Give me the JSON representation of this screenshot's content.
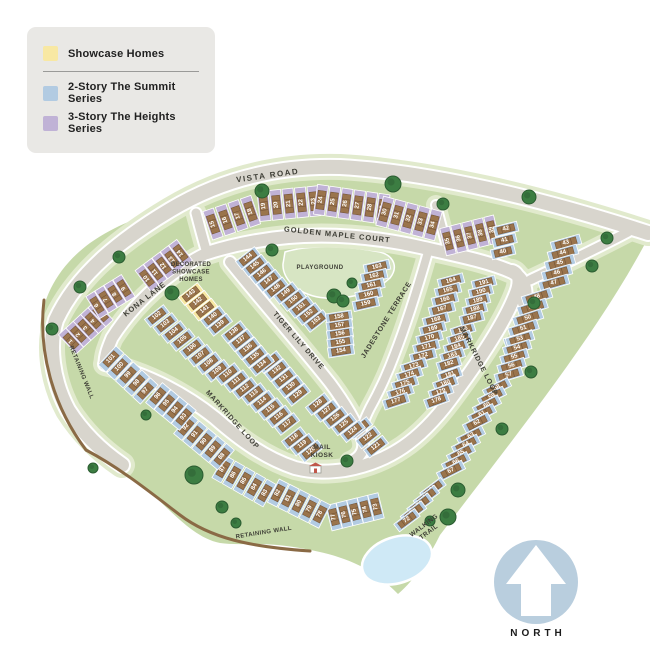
{
  "legend": {
    "items": [
      {
        "label": "Showcase Homes",
        "series": "showcase"
      },
      {
        "label": "2-Story The Summit Series",
        "series": "summit"
      },
      {
        "label": "3-Story The Heights Series",
        "series": "heights"
      }
    ]
  },
  "north": {
    "label": "NORTH"
  },
  "colors": {
    "land": "#c6d9a9",
    "verge": "#e1eacd",
    "road": "#d8d5cd",
    "road_edge": "#ffffff",
    "wall": "#8a6a45",
    "house": "#9a744c",
    "house_line": "#6e4f33",
    "tree": "#3c7d42",
    "tree_edge": "#2b5c31",
    "pond": "#cfe9f6",
    "playground": "#d7e5c3",
    "north_circle": "#b9cede",
    "series": {
      "summit": "#b2cbe2",
      "heights": "#c0b2d6",
      "showcase": "#f8e8a3"
    }
  },
  "map": {
    "labels": [
      {
        "id": "vista-road",
        "text": "VISTA ROAD",
        "x": 268,
        "y": 178,
        "rot": -8,
        "size": 8,
        "ls": 1.5
      },
      {
        "id": "golden-maple-court",
        "text": "GOLDEN MAPLE COURT",
        "x": 337,
        "y": 237,
        "rot": 6,
        "size": 7.5,
        "ls": 1
      },
      {
        "id": "kona-lane",
        "text": "KONA LANE",
        "x": 146,
        "y": 301,
        "rot": -38,
        "size": 7.5,
        "ls": 0.8
      },
      {
        "id": "tiger-lily-drive",
        "text": "TIGER LILY DRIVE",
        "x": 297,
        "y": 342,
        "rot": 49,
        "size": 7,
        "ls": 0.8
      },
      {
        "id": "jadestone-terrace",
        "text": "JADESTONE TERRACE",
        "x": 388,
        "y": 321,
        "rot": -58,
        "size": 7,
        "ls": 0.6
      },
      {
        "id": "markridge-loop-west",
        "text": "MARKRIDGE LOOP",
        "x": 231,
        "y": 421,
        "rot": 48,
        "size": 7,
        "ls": 0.8
      },
      {
        "id": "markridge-loop-east",
        "text": "MARKRIDGE LOOP",
        "x": 477,
        "y": 362,
        "rot": 63,
        "size": 7,
        "ls": 0.8
      },
      {
        "id": "retaining-wall-left",
        "text": "RETAINING WALL",
        "x": 80,
        "y": 373,
        "rot": 68,
        "size": 6,
        "ls": 0.4
      },
      {
        "id": "retaining-wall-bottom",
        "text": "RETAINING WALL",
        "x": 264,
        "y": 534,
        "rot": -9,
        "size": 6,
        "ls": 0.4
      },
      {
        "id": "playground",
        "lines": [
          "PLAYGROUND"
        ],
        "x": 320,
        "y": 269,
        "rot": 0,
        "size": 6,
        "ls": 0.5
      },
      {
        "id": "mail-kiosk",
        "lines": [
          "MAIL",
          "KIOSK"
        ],
        "x": 322,
        "y": 449,
        "rot": 0,
        "size": 6.5,
        "ls": 0.4
      },
      {
        "id": "walking-trail",
        "lines": [
          "WALKING",
          "TRAIL"
        ],
        "x": 425,
        "y": 527,
        "rot": -37,
        "size": 6.5,
        "ls": 0.4
      },
      {
        "id": "decorated-showcase-homes",
        "lines": [
          "DECORATED",
          "SHOWCASE",
          "HOMES"
        ],
        "x": 191,
        "y": 266,
        "rot": 0,
        "size": 6,
        "ls": 0.3
      }
    ],
    "lot_groups": [
      {
        "series": "heights",
        "nums": [
          15,
          16,
          17,
          18
        ],
        "start": [
          213,
          224
        ],
        "step": [
          12.5,
          -4.2
        ],
        "angle": -19,
        "lot": [
          11,
          30
        ],
        "text_rot": -90
      },
      {
        "series": "heights",
        "nums": [
          19,
          20,
          21,
          22,
          23
        ],
        "start": [
          264,
          206
        ],
        "step": [
          12.5,
          -1.2
        ],
        "angle": -6,
        "lot": [
          11,
          30
        ],
        "text_rot": -90
      },
      {
        "series": "heights",
        "nums": [
          24,
          25,
          26,
          27,
          28,
          29
        ],
        "start": [
          321,
          200
        ],
        "step": [
          12.3,
          1.8
        ],
        "angle": 8,
        "lot": [
          11,
          30
        ],
        "text_rot": -90
      },
      {
        "series": "heights",
        "nums": [
          30,
          31,
          32,
          33,
          34
        ],
        "start": [
          385,
          212
        ],
        "step": [
          12,
          3.2
        ],
        "angle": 15,
        "lot": [
          11,
          30
        ],
        "text_rot": -90
      },
      {
        "series": "heights",
        "nums": [
          35,
          36,
          37,
          38,
          39
        ],
        "start": [
          448,
          241
        ],
        "step": [
          11,
          -2.8
        ],
        "angle": -14,
        "lot": [
          10,
          28
        ],
        "text_rot": -90
      },
      {
        "series": "heights",
        "nums": [
          1,
          2,
          3,
          4,
          5
        ],
        "start": [
          71,
          341
        ],
        "step": [
          7.4,
          -6.8
        ],
        "angle": -43,
        "lot": [
          10,
          26
        ],
        "text_rot": -90
      },
      {
        "series": "heights",
        "nums": [
          6,
          7,
          8,
          9
        ],
        "start": [
          97,
          305
        ],
        "step": [
          9,
          -5.6
        ],
        "angle": -32,
        "lot": [
          10,
          26
        ],
        "text_rot": -90
      },
      {
        "series": "heights",
        "nums": [
          10,
          11,
          12,
          13,
          14
        ],
        "start": [
          147,
          278
        ],
        "step": [
          8.4,
          -6.3
        ],
        "angle": -37,
        "lot": [
          10,
          26
        ],
        "text_rot": -90
      },
      {
        "series": "summit",
        "nums": [
          42,
          41,
          40
        ],
        "start": [
          506,
          229
        ],
        "step": [
          -1.5,
          11.5
        ],
        "angle": -14,
        "lot": [
          24,
          10
        ],
        "text_rot": 0
      },
      {
        "series": "summit",
        "nums": [
          43,
          44,
          45,
          46,
          47
        ],
        "start": [
          566,
          243
        ],
        "step": [
          -3,
          10
        ],
        "angle": -16,
        "lot": [
          30,
          10
        ],
        "text_rot": 0
      },
      {
        "series": "summit",
        "nums": [
          48,
          49,
          50,
          51,
          52
        ],
        "start": [
          537,
          297
        ],
        "step": [
          -4.5,
          10.5
        ],
        "angle": -18,
        "lot": [
          30,
          10
        ],
        "text_rot": 0
      },
      {
        "series": "summit",
        "nums": [
          53,
          54,
          55,
          56,
          57
        ],
        "start": [
          520,
          339
        ],
        "step": [
          -2.8,
          9
        ],
        "angle": -17,
        "lot": [
          28,
          9.5
        ],
        "text_rot": 0
      },
      {
        "series": "summit",
        "nums": [
          58,
          59,
          60,
          61,
          62
        ],
        "start": [
          497,
          388
        ],
        "step": [
          -5,
          8.7
        ],
        "angle": -27,
        "lot": [
          28,
          9.5
        ],
        "text_rot": 0
      },
      {
        "series": "summit",
        "nums": [
          63,
          64,
          65,
          66,
          67
        ],
        "start": [
          471,
          436
        ],
        "step": [
          -5,
          8.7
        ],
        "angle": -27,
        "lot": [
          28,
          9.5
        ],
        "text_rot": 0
      },
      {
        "series": "summit",
        "nums": [
          68,
          69,
          70,
          71,
          72
        ],
        "start": [
          433,
          489
        ],
        "step": [
          -6.5,
          7.8
        ],
        "angle": -37,
        "lot": [
          26,
          9.5
        ],
        "text_rot": 0
      },
      {
        "series": "summit",
        "nums": [
          77,
          76,
          75,
          74,
          73
        ],
        "start": [
          334,
          517
        ],
        "step": [
          10.5,
          -2.6
        ],
        "angle": -14,
        "lot": [
          10.5,
          26
        ],
        "text_rot": -90
      },
      {
        "series": "summit",
        "nums": [
          82,
          81,
          80,
          79,
          78
        ],
        "start": [
          278,
          493
        ],
        "step": [
          10.5,
          5.3
        ],
        "angle": 27,
        "lot": [
          10.5,
          26
        ],
        "text_rot": -90
      },
      {
        "series": "summit",
        "nums": [
          87,
          86,
          85,
          84,
          83
        ],
        "start": [
          223,
          469
        ],
        "step": [
          10.5,
          6
        ],
        "angle": 30,
        "lot": [
          10.5,
          26
        ],
        "text_rot": -90
      },
      {
        "series": "summit",
        "nums": [
          92,
          91,
          90,
          89,
          88
        ],
        "start": [
          186,
          427
        ],
        "step": [
          9,
          7.4
        ],
        "angle": 40,
        "lot": [
          10.5,
          26
        ],
        "text_rot": -90
      },
      {
        "series": "summit",
        "nums": [
          96,
          95,
          94,
          93
        ],
        "start": [
          158,
          396
        ],
        "step": [
          8.6,
          7
        ],
        "angle": 40,
        "lot": [
          10.5,
          26
        ],
        "text_rot": -90
      },
      {
        "series": "summit",
        "nums": [
          101,
          100,
          99,
          98,
          97
        ],
        "start": [
          111,
          359
        ],
        "step": [
          8.6,
          8
        ],
        "angle": 43,
        "lot": [
          10.5,
          26
        ],
        "text_rot": -90
      },
      {
        "series": "summit",
        "nums": [
          102,
          103,
          104,
          105
        ],
        "start": [
          157,
          316
        ],
        "step": [
          8.5,
          8
        ],
        "angle": -38,
        "lot": [
          24,
          10
        ],
        "text_rot": 0
      },
      {
        "series": "summit",
        "nums": [
          106,
          107,
          108,
          109
        ],
        "start": [
          192,
          348
        ],
        "step": [
          8.5,
          7.6
        ],
        "angle": -38,
        "lot": [
          24,
          10
        ],
        "text_rot": 0
      },
      {
        "series": "summit",
        "nums": [
          110,
          111,
          112
        ],
        "start": [
          228,
          374
        ],
        "step": [
          8.5,
          7.2
        ],
        "angle": -38,
        "lot": [
          24,
          10
        ],
        "text_rot": 0
      },
      {
        "series": "summit",
        "nums": [
          113,
          114,
          115,
          116,
          117
        ],
        "start": [
          254,
          394
        ],
        "step": [
          8.3,
          7.5
        ],
        "angle": -38,
        "lot": [
          24,
          10
        ],
        "text_rot": 0
      },
      {
        "series": "summit",
        "nums": [
          118,
          119,
          120
        ],
        "start": [
          294,
          438
        ],
        "step": [
          8.5,
          6.6
        ],
        "angle": -38,
        "lot": [
          24,
          10
        ],
        "text_rot": 0
      },
      {
        "series": "summit",
        "nums": [
          123,
          122,
          121
        ],
        "start": [
          360,
          428
        ],
        "step": [
          8,
          9.3
        ],
        "angle": -38,
        "lot": [
          24,
          10
        ],
        "text_rot": 0
      },
      {
        "series": "summit",
        "nums": [
          128,
          127,
          126,
          125,
          124
        ],
        "start": [
          318,
          404
        ],
        "step": [
          8.7,
          6.8
        ],
        "angle": -38,
        "lot": [
          24,
          10
        ],
        "text_rot": 0
      },
      {
        "series": "summit",
        "nums": [
          133,
          132,
          131,
          130,
          129
        ],
        "start": [
          270,
          362
        ],
        "step": [
          7,
          8.2
        ],
        "angle": -38,
        "lot": [
          24,
          10
        ],
        "text_rot": 0
      },
      {
        "series": "summit",
        "nums": [
          138,
          137,
          136,
          135,
          134
        ],
        "start": [
          234,
          332
        ],
        "step": [
          7,
          8.2
        ],
        "angle": -38,
        "lot": [
          24,
          10
        ],
        "text_rot": 0
      },
      {
        "series": "showcase",
        "nums": [
          143,
          142,
          141
        ],
        "start": [
          191,
          294
        ],
        "step": [
          7,
          7.8
        ],
        "angle": -38,
        "lot": [
          24,
          10
        ],
        "text_rot": 0
      },
      {
        "series": "summit",
        "nums": [
          140,
          139
        ],
        "start": [
          213,
          317
        ],
        "step": [
          7,
          7.8
        ],
        "angle": -38,
        "lot": [
          24,
          10
        ],
        "text_rot": 0
      },
      {
        "series": "summit",
        "nums": [
          144,
          145,
          146,
          147,
          148
        ],
        "start": [
          248,
          258
        ],
        "step": [
          7,
          7.6
        ],
        "angle": -38,
        "lot": [
          24,
          10
        ],
        "text_rot": 0
      },
      {
        "series": "summit",
        "nums": [
          149,
          150,
          151,
          152,
          153
        ],
        "start": [
          286,
          293
        ],
        "step": [
          7.6,
          7
        ],
        "angle": -38,
        "lot": [
          24,
          10
        ],
        "text_rot": 0
      },
      {
        "series": "summit",
        "nums": [
          163,
          162,
          161,
          160,
          159
        ],
        "start": [
          377,
          267
        ],
        "step": [
          -2.8,
          9.2
        ],
        "angle": -13,
        "lot": [
          26,
          10
        ],
        "text_rot": 0
      },
      {
        "series": "summit",
        "nums": [
          158,
          157,
          156,
          155,
          154
        ],
        "start": [
          339,
          317
        ],
        "step": [
          0.5,
          8.5
        ],
        "angle": -9,
        "lot": [
          26,
          10
        ],
        "text_rot": 0
      },
      {
        "series": "summit",
        "nums": [
          164,
          165,
          166,
          167
        ],
        "start": [
          451,
          281
        ],
        "step": [
          -3,
          9.4
        ],
        "angle": -15,
        "lot": [
          26,
          10
        ],
        "text_rot": 0
      },
      {
        "series": "summit",
        "nums": [
          168,
          169,
          170,
          171,
          172
        ],
        "start": [
          436,
          320
        ],
        "step": [
          -3.2,
          9
        ],
        "angle": -15,
        "lot": [
          26,
          10
        ],
        "text_rot": 0
      },
      {
        "series": "summit",
        "nums": [
          173,
          174,
          175,
          176,
          177
        ],
        "start": [
          414,
          366
        ],
        "step": [
          -4.5,
          8.8
        ],
        "angle": -18,
        "lot": [
          26,
          10
        ],
        "text_rot": 0
      },
      {
        "series": "summit",
        "nums": [
          181,
          180,
          179,
          178
        ],
        "start": [
          450,
          375
        ],
        "step": [
          -4.5,
          8.5
        ],
        "angle": -20,
        "lot": [
          24,
          10
        ],
        "text_rot": 0
      },
      {
        "series": "summit",
        "nums": [
          186,
          185,
          184,
          183,
          182
        ],
        "start": [
          463,
          330
        ],
        "step": [
          -3.5,
          8.5
        ],
        "angle": -18,
        "lot": [
          24,
          10
        ],
        "text_rot": 0
      },
      {
        "series": "summit",
        "nums": [
          191,
          190,
          189,
          188,
          187
        ],
        "start": [
          484,
          283
        ],
        "step": [
          -3,
          8.8
        ],
        "angle": -15,
        "lot": [
          24,
          10
        ],
        "text_rot": 0
      }
    ],
    "trees": [
      [
        262,
        191,
        7
      ],
      [
        393,
        184,
        8
      ],
      [
        529,
        197,
        7
      ],
      [
        443,
        204,
        6
      ],
      [
        607,
        238,
        6
      ],
      [
        592,
        266,
        6
      ],
      [
        534,
        303,
        6
      ],
      [
        531,
        372,
        6
      ],
      [
        502,
        429,
        6
      ],
      [
        458,
        490,
        7
      ],
      [
        448,
        517,
        8
      ],
      [
        430,
        521,
        5
      ],
      [
        352,
        283,
        5
      ],
      [
        334,
        296,
        7
      ],
      [
        343,
        301,
        6
      ],
      [
        272,
        250,
        6
      ],
      [
        172,
        293,
        7
      ],
      [
        119,
        257,
        6
      ],
      [
        80,
        287,
        6
      ],
      [
        52,
        329,
        6
      ],
      [
        146,
        415,
        5
      ],
      [
        194,
        475,
        9
      ],
      [
        222,
        507,
        6
      ],
      [
        236,
        523,
        5
      ],
      [
        347,
        461,
        6
      ],
      [
        93,
        468,
        5
      ]
    ],
    "pond": {
      "cx": 397,
      "cy": 560,
      "rx": 36,
      "ry": 23,
      "rot": -18
    }
  }
}
